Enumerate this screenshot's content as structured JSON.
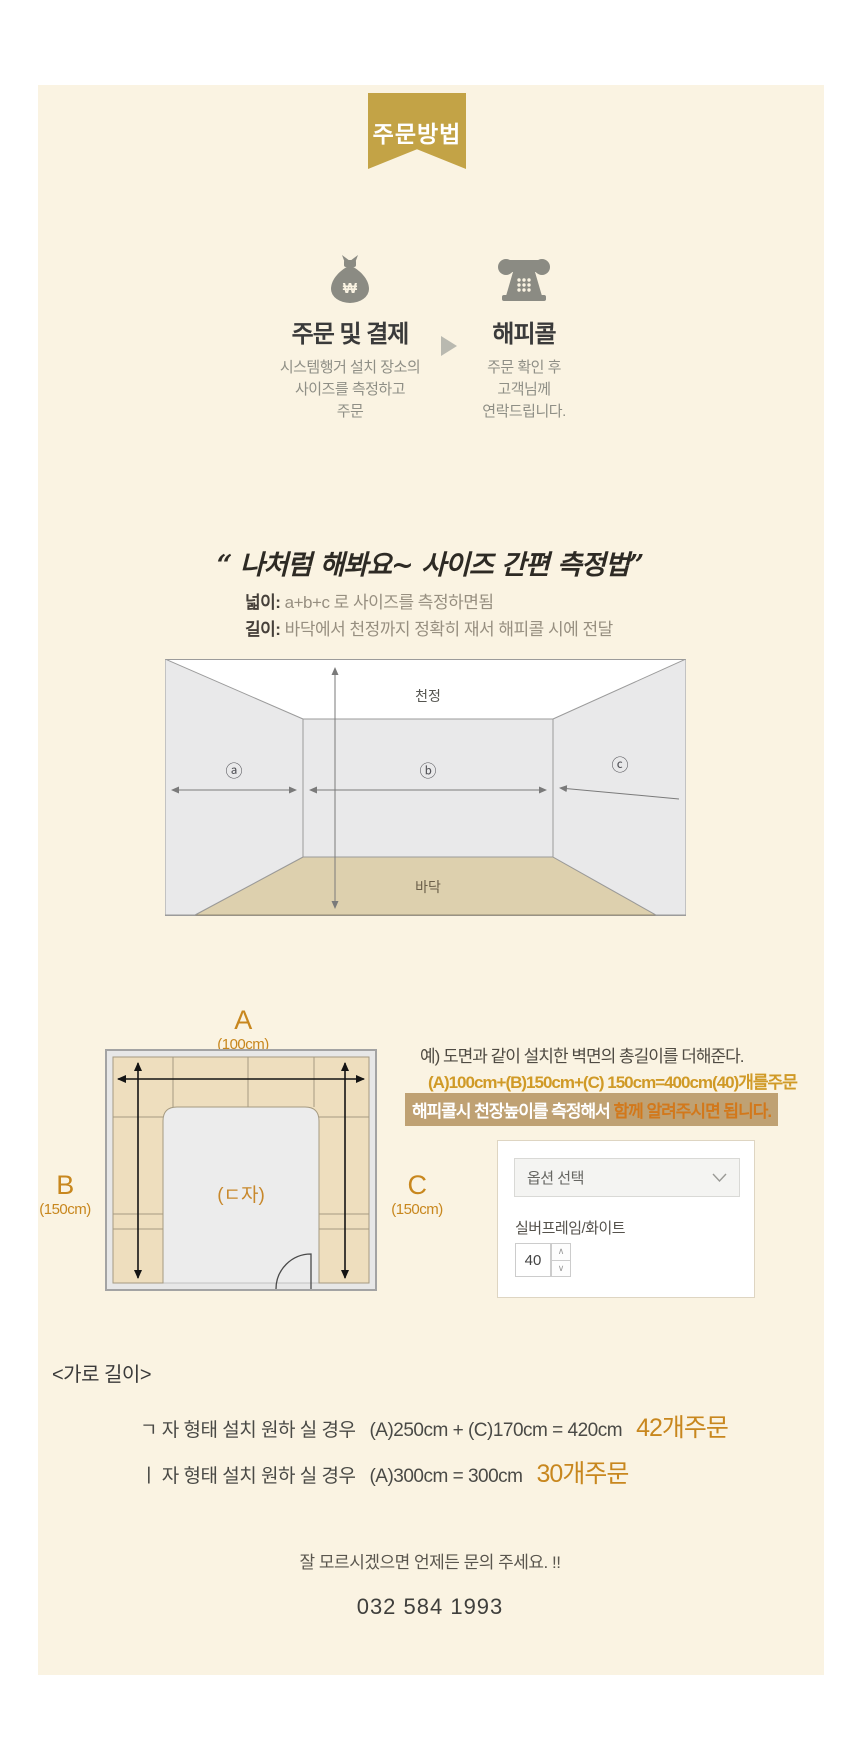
{
  "badge": {
    "label": "주문방법"
  },
  "steps": {
    "step1": {
      "title": "주문 및 결제",
      "desc_lines": [
        "시스템행거 설치 장소의",
        "사이즈를 측정하고",
        "주문"
      ],
      "icon": "money-bag-icon",
      "icon_symbol": "₩"
    },
    "step2": {
      "title": "해피콜",
      "desc_lines": [
        "주문 확인 후",
        "고객님께",
        "연락드립니다."
      ],
      "icon": "phone-icon"
    }
  },
  "measure_guide": {
    "quote": "“ 나처럼 해봐요~ 사이즈 간편 측정법”",
    "width_label": "넓이:",
    "width_text": " a+b+c 로 사이즈를 측정하면됨",
    "height_label": "길이:",
    "height_text": " 바닥에서 천정까지 정확히 재서 해피콜 시에 전달"
  },
  "room_diagram": {
    "ceiling_label": "천정",
    "floor_label": "바닥",
    "wall_a": "ⓐ",
    "wall_b": "ⓑ",
    "wall_c": "ⓒ"
  },
  "floor_plan": {
    "a_label": "A",
    "a_size": "(100cm)",
    "b_label": "B",
    "b_size": "(150cm)",
    "c_label": "C",
    "c_size": "(150cm)",
    "shape_label": "(ㄷ자)"
  },
  "example": {
    "line1": "예) 도면과 같이 설치한 벽면의 총길이를 더해준다.",
    "line2": "(A)100cm+(B)150cm+(C) 150cm=400cm(40)개를주문",
    "highlight_part1": "해피콜시 천장높이를 측정해서 ",
    "highlight_part2": "함께 알려주시면 됩니다."
  },
  "option_box": {
    "select_placeholder": "옵션 선택",
    "option_name": "실버프레임/화이트",
    "quantity": "40"
  },
  "horizontal_length": {
    "title": "<가로 길이>",
    "case1_text": "ㄱ 자 형태 설치 원하 실 경우",
    "case1_formula": "(A)250cm + (C)170cm = 420cm",
    "case1_order": "42개주문",
    "case2_text": "ㅣ 자 형태 설치 원하 실 경우",
    "case2_formula": "(A)300cm = 300cm",
    "case2_order": "30개주문"
  },
  "footer": {
    "help_text": "잘 모르시겠으면 언제든 문의 주세요. !!",
    "phone": "032 584 1993"
  },
  "colors": {
    "cream_background": "#faf3e2",
    "ribbon_gold": "#c3a346",
    "accent_orange": "#c8871e",
    "highlight_bar_bg": "#bfa173",
    "highlight_text_orange": "#d2781b",
    "icon_gray": "#8b8b83",
    "floor_tan": "#ddd0ae",
    "wall_gray": "#e9e9ea",
    "shelf_tan": "#eedebe"
  }
}
